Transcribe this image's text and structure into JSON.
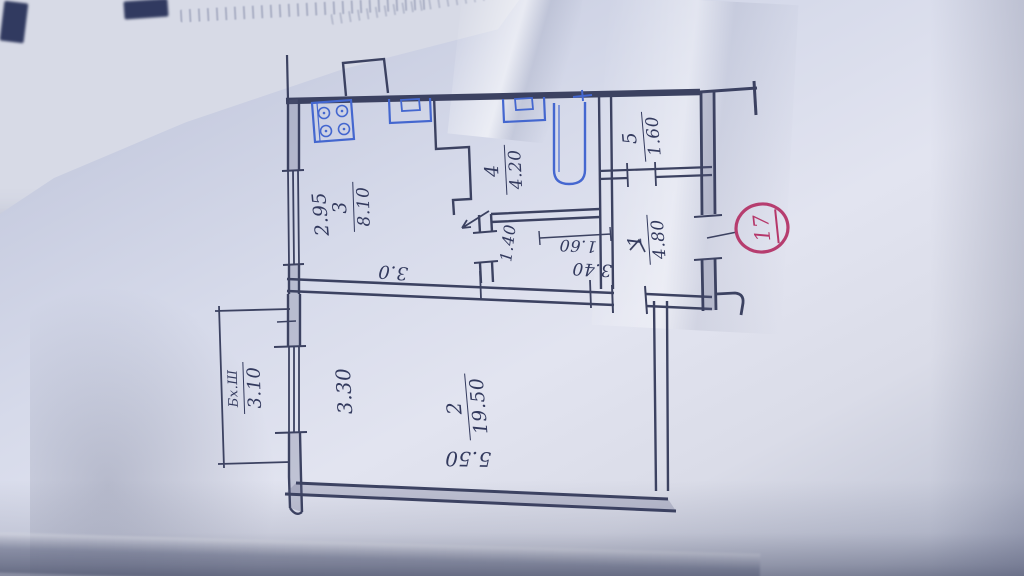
{
  "plan": {
    "rooms": [
      {
        "number": "1",
        "area": "4.80"
      },
      {
        "number": "2",
        "area": "19.50"
      },
      {
        "number": "3",
        "area": "8.10"
      },
      {
        "number": "4",
        "area": "4.20"
      },
      {
        "number": "5",
        "area": "1.60"
      }
    ],
    "dimensions": {
      "kitchen_width": "2.95",
      "kitchen_length": "3.0",
      "corridor_width": "1.40",
      "hall_width": "1.60",
      "hall_length": "3.40",
      "room2_width": "3.30",
      "room2_length": "5.50"
    },
    "balcony": {
      "label": "Бх.Ш",
      "width": "3.10"
    },
    "stamp": {
      "number": "17"
    },
    "icons": {
      "stove": "stove-icon",
      "kitchen_sink": "sink-icon",
      "bath_sink": "sink-icon",
      "bathtub": "bathtub-icon"
    }
  },
  "colors": {
    "ink": "#363c5c",
    "fixtures": "#3f63cf",
    "stamp": "#b5376a",
    "paper": "#dfe2ee"
  }
}
